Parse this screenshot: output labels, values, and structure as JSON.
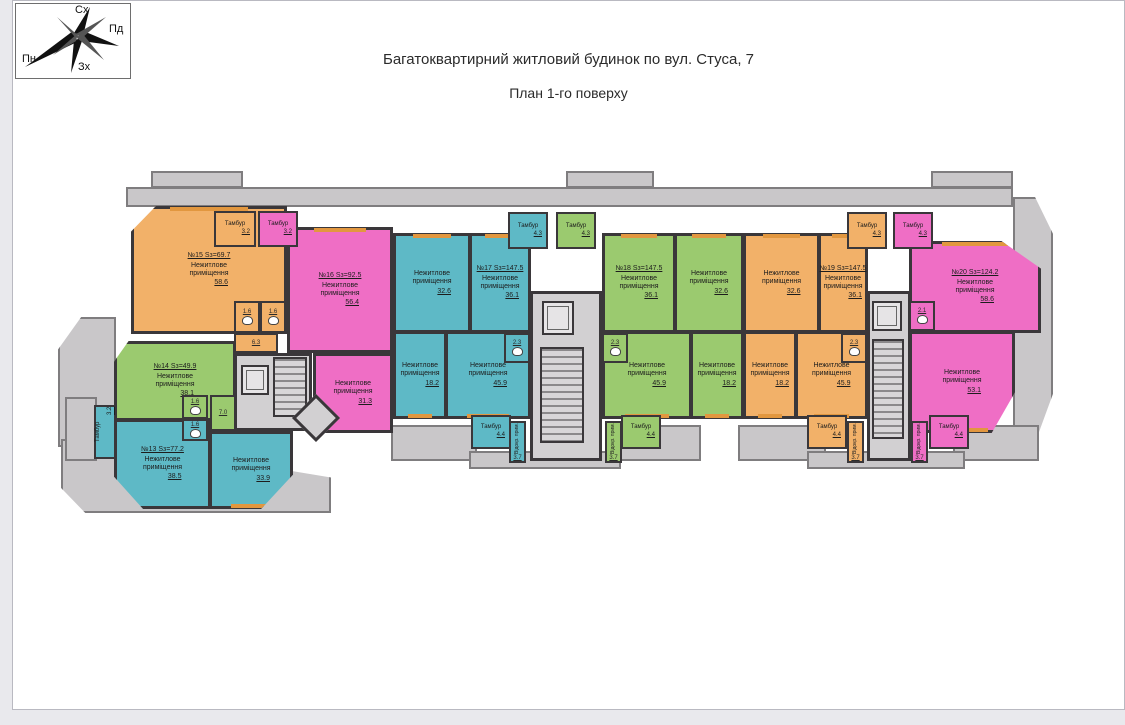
{
  "page": {
    "title1": "Багатоквартирний житловий будинок по вул. Стуса, 7",
    "title2": "План 1-го поверху"
  },
  "compass": {
    "top": "Сх",
    "right": "Пд",
    "bottom": "Зх",
    "left": "Пн"
  },
  "labels": {
    "room": "Нежитлове приміщення",
    "tambour": "Тамбур",
    "vest": "Відокр. прим."
  },
  "colors": {
    "orange": "#f2b169",
    "pink": "#ef6ec5",
    "teal": "#5eb9c6",
    "green": "#9bca6f",
    "wall": "#3a373a",
    "terrace": "#c9c7c9",
    "terraceline": "#7f7d7f",
    "core": "#d2d0d2",
    "win": "#e2973f",
    "pagebg": "#e9e9ed"
  },
  "units": {
    "u13": {
      "header": "№13 Sз=77.2",
      "rooms": [
        "38.5",
        "33.9"
      ],
      "tambour": "3.2"
    },
    "u14": {
      "header": "№14 Sз=49.9",
      "rooms": [
        "38.1"
      ],
      "wc1": "1.6",
      "wc2": "1.6",
      "hall": "7.0"
    },
    "u15": {
      "header": "№15 Sз=69.7",
      "rooms": [
        "58.6"
      ],
      "tambour": "3.2",
      "wc1": "1.6",
      "wc2": "1.6",
      "corridor": "6.3"
    },
    "u16": {
      "header": "№16 Sз=92.5",
      "rooms": [
        "56.4",
        "31.3"
      ],
      "tambour": "3.2"
    },
    "u17": {
      "header": "№17 Sз=147.5",
      "rooms": [
        "32.6",
        "36.1",
        "18.2",
        "45.9"
      ],
      "wc": "2.3",
      "tambour_top": "4.3",
      "tambour_bottom": "4.4",
      "vest": "3.7"
    },
    "u18": {
      "header": "№18 Sз=147.5",
      "rooms": [
        "36.1",
        "32.6",
        "45.9",
        "18.2"
      ],
      "wc": "2.3",
      "tambour_top": "4.3",
      "tambour_bottom": "4.4",
      "vest": "3.7"
    },
    "u19": {
      "header": "№19 Sз=147.5",
      "rooms": [
        "32.6",
        "36.1",
        "18.2",
        "45.9"
      ],
      "wc": "2.3",
      "tambour_top": "4.3",
      "tambour_bottom": "4.4",
      "vest": "3.7"
    },
    "u20": {
      "header": "№20 Sз=124.2",
      "rooms": [
        "58.6",
        "53.1"
      ],
      "wc": "2.1",
      "tambour_top": "4.3",
      "tambour_bottom": "4.4",
      "vest": "3.7"
    }
  }
}
